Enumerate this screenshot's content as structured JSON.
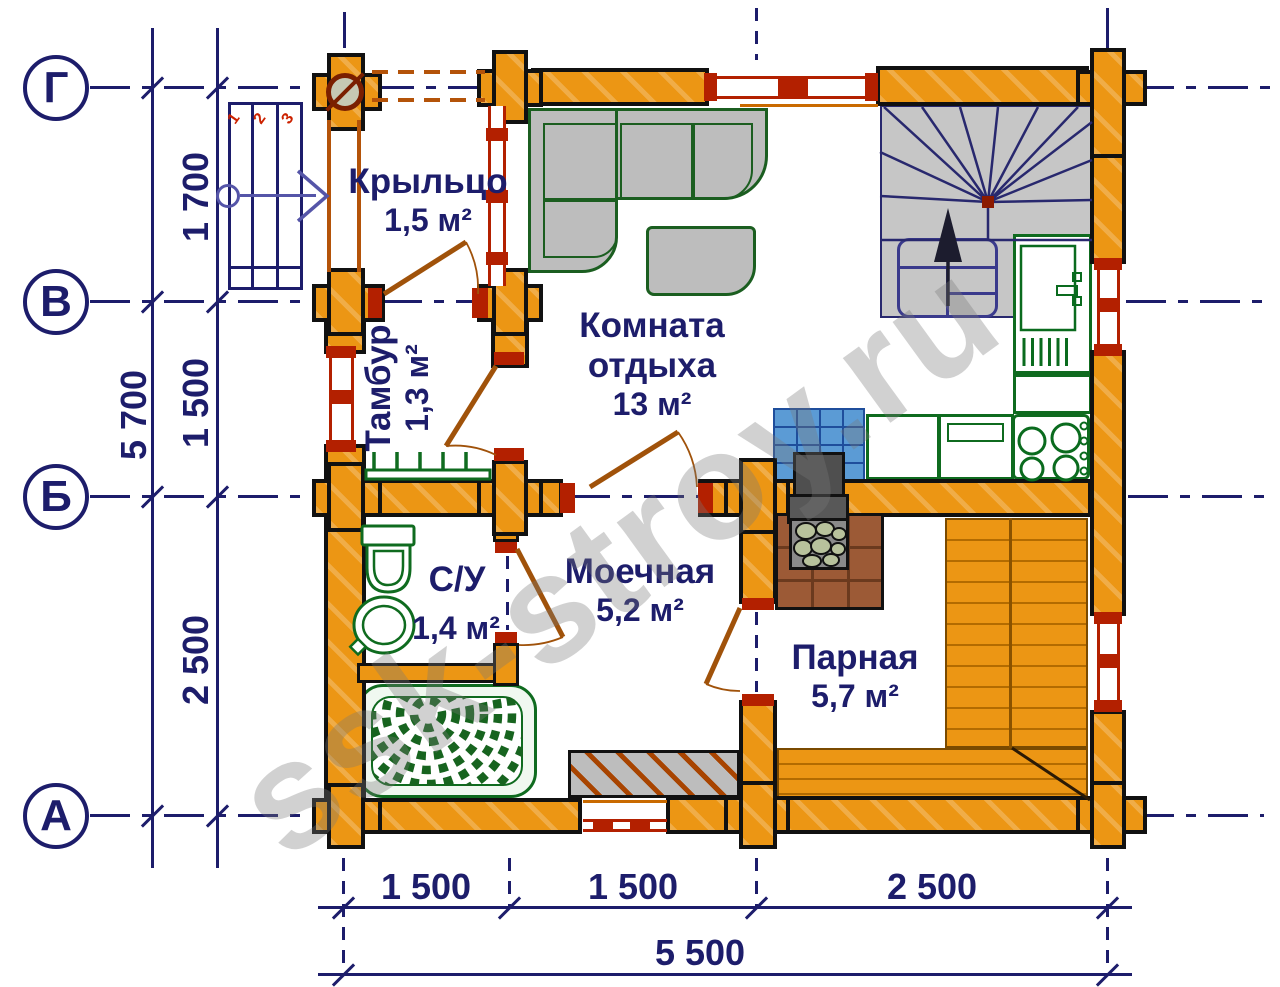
{
  "watermark": "ssk-stroy.ru",
  "colors": {
    "wall_orange": "#EC9614",
    "axis_navy": "#1d1d6b",
    "window_red": "#b32000",
    "fixture_green": "#0f6b1f",
    "tile_blue": "#5b9bd5",
    "hearth_brown": "#9c5a36",
    "door_brown": "#a0520a",
    "stair_gray": "#c6c6c6"
  },
  "axes": {
    "rows": [
      {
        "label": "Г"
      },
      {
        "label": "В"
      },
      {
        "label": "Б"
      },
      {
        "label": "А"
      }
    ]
  },
  "dimensions": {
    "left_total": "5 700",
    "left_segments": [
      "1 700",
      "1 500",
      "2 500"
    ],
    "bottom_segments": [
      "1 500",
      "1 500",
      "2 500"
    ],
    "bottom_total": "5 500"
  },
  "rooms": {
    "porch": {
      "name": "Крыльцо",
      "area": "1,5 м²"
    },
    "tambour": {
      "name": "Тамбур",
      "area": "1,3 м²"
    },
    "rest": {
      "name_line1": "Комната",
      "name_line2": "отдыха",
      "area": "13 м²"
    },
    "wc": {
      "name": "С/У",
      "area": "1,4 м²"
    },
    "washing": {
      "name": "Моечная",
      "area": "5,2 м²"
    },
    "steam": {
      "name": "Парная",
      "area": "5,7 м²"
    }
  },
  "stairs": {
    "step_numbers": [
      "1",
      "2",
      "3"
    ]
  }
}
